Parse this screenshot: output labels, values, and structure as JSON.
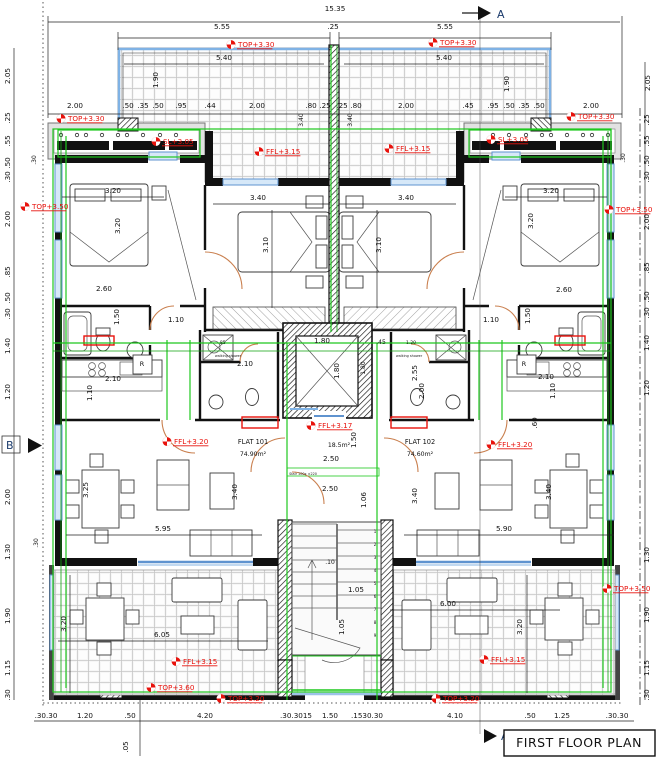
{
  "drawing": {
    "title": "FIRST FLOOR PLAN"
  },
  "section_markers": {
    "top": "A",
    "bottom": "A",
    "left": "B"
  },
  "rooms": {
    "flat1": {
      "name": "FLAT 101",
      "area": "74.90m²"
    },
    "flat2": {
      "name": "FLAT 102",
      "area": "74.60m²"
    },
    "core_area": "18.5m²",
    "stair_note": "Stair 100x ±220",
    "walking_shower": "walking shower",
    "fridge": "R"
  },
  "colors": {
    "annotation_red": "#e8120c",
    "overlay_green": "#1ec81e",
    "window_blue": "#5f93cf",
    "door_orange": "#c97f4e"
  },
  "levels": [
    {
      "t": "TOP+3.30",
      "x": 238,
      "y": 47
    },
    {
      "t": "TOP+3.30",
      "x": 440,
      "y": 45
    },
    {
      "t": "TOP+3.30",
      "x": 68,
      "y": 121
    },
    {
      "t": "TOP+3.30",
      "x": 578,
      "y": 119
    },
    {
      "t": "SL+3.05",
      "x": 163,
      "y": 144
    },
    {
      "t": "SL+3.05",
      "x": 498,
      "y": 142
    },
    {
      "t": "FFL+3.15",
      "x": 266,
      "y": 154
    },
    {
      "t": "FFL+3.15",
      "x": 396,
      "y": 151
    },
    {
      "t": "TOP+3.50",
      "x": 32,
      "y": 209
    },
    {
      "t": "TOP+3.50",
      "x": 616,
      "y": 212
    },
    {
      "t": "FFL+3.17",
      "x": 318,
      "y": 428
    },
    {
      "t": "FFL+3.20",
      "x": 174,
      "y": 444
    },
    {
      "t": "FFL+3.20",
      "x": 498,
      "y": 447
    },
    {
      "t": "FFL+3.15",
      "x": 183,
      "y": 664
    },
    {
      "t": "FFL+3.15",
      "x": 491,
      "y": 662
    },
    {
      "t": "TOP+3.60",
      "x": 158,
      "y": 690
    },
    {
      "t": "TOP+3.20",
      "x": 228,
      "y": 701
    },
    {
      "t": "TOP+3.20",
      "x": 443,
      "y": 701
    },
    {
      "t": "TOP+3.50",
      "x": 614,
      "y": 591
    }
  ],
  "dimensions": [
    {
      "t": "15.35",
      "x": 335,
      "y": 11
    },
    {
      "t": "5.55",
      "x": 222,
      "y": 29
    },
    {
      "t": ".25",
      "x": 333,
      "y": 29
    },
    {
      "t": "5.55",
      "x": 445,
      "y": 29
    },
    {
      "t": "5.40",
      "x": 224,
      "y": 60
    },
    {
      "t": "5.40",
      "x": 444,
      "y": 60
    },
    {
      "t": "1.90",
      "x": 158,
      "y": 80,
      "r": 1
    },
    {
      "t": "1.90",
      "x": 509,
      "y": 84,
      "r": 1
    },
    {
      "t": "2.00",
      "x": 75,
      "y": 108
    },
    {
      "t": ".50",
      "x": 128,
      "y": 108
    },
    {
      "t": ".35",
      "x": 143,
      "y": 108
    },
    {
      "t": ".50",
      "x": 158,
      "y": 108
    },
    {
      "t": ".95",
      "x": 181,
      "y": 108
    },
    {
      "t": ".44",
      "x": 210,
      "y": 108
    },
    {
      "t": "2.00",
      "x": 257,
      "y": 108
    },
    {
      "t": ".80",
      "x": 311,
      "y": 108
    },
    {
      "t": ".25",
      "x": 325,
      "y": 108
    },
    {
      "t": "3.40",
      "x": 303,
      "y": 120,
      "r": 1,
      "s": 6
    },
    {
      "t": "3.40",
      "x": 352,
      "y": 120,
      "r": 1,
      "s": 6
    },
    {
      "t": ".25",
      "x": 342,
      "y": 108
    },
    {
      "t": ".80",
      "x": 356,
      "y": 108
    },
    {
      "t": "2.00",
      "x": 406,
      "y": 108
    },
    {
      "t": ".45",
      "x": 468,
      "y": 108
    },
    {
      "t": ".95",
      "x": 493,
      "y": 108
    },
    {
      "t": ".50",
      "x": 509,
      "y": 108
    },
    {
      "t": ".35",
      "x": 524,
      "y": 108
    },
    {
      "t": ".50",
      "x": 539,
      "y": 108
    },
    {
      "t": "2.00",
      "x": 591,
      "y": 108
    },
    {
      "t": "2.05",
      "x": 650,
      "y": 83,
      "r": 1
    },
    {
      "t": "2.05",
      "x": 10,
      "y": 76,
      "r": 1
    },
    {
      "t": ".25",
      "x": 10,
      "y": 118,
      "r": 1
    },
    {
      "t": ".55",
      "x": 10,
      "y": 141,
      "r": 1
    },
    {
      "t": ".50",
      "x": 10,
      "y": 163,
      "r": 1
    },
    {
      "t": ".30",
      "x": 10,
      "y": 177,
      "r": 1
    },
    {
      "t": "2.00",
      "x": 10,
      "y": 219,
      "r": 1
    },
    {
      "t": ".85",
      "x": 10,
      "y": 272,
      "r": 1
    },
    {
      "t": ".50",
      "x": 10,
      "y": 298,
      "r": 1
    },
    {
      "t": ".30",
      "x": 10,
      "y": 314,
      "r": 1
    },
    {
      "t": "1.40",
      "x": 10,
      "y": 346,
      "r": 1
    },
    {
      "t": "1.20",
      "x": 10,
      "y": 392,
      "r": 1
    },
    {
      "t": "2.00",
      "x": 10,
      "y": 497,
      "r": 1
    },
    {
      "t": "1.30",
      "x": 10,
      "y": 552,
      "r": 1
    },
    {
      "t": "1.90",
      "x": 10,
      "y": 616,
      "r": 1
    },
    {
      "t": "1.15",
      "x": 10,
      "y": 668,
      "r": 1
    },
    {
      "t": ".30",
      "x": 10,
      "y": 695,
      "r": 1
    },
    {
      "t": ".30",
      "x": 36,
      "y": 160,
      "r": 1,
      "s": 6
    },
    {
      "t": ".30",
      "x": 38,
      "y": 543,
      "r": 1,
      "s": 6
    },
    {
      "t": ".30",
      "x": 625,
      "y": 158,
      "r": 1,
      "s": 6
    },
    {
      "t": ".25",
      "x": 649,
      "y": 120,
      "r": 1
    },
    {
      "t": ".55",
      "x": 649,
      "y": 141,
      "r": 1
    },
    {
      "t": ".50",
      "x": 649,
      "y": 161,
      "r": 1
    },
    {
      "t": ".30",
      "x": 649,
      "y": 177,
      "r": 1
    },
    {
      "t": "2.00",
      "x": 649,
      "y": 222,
      "r": 1
    },
    {
      "t": ".85",
      "x": 649,
      "y": 268,
      "r": 1
    },
    {
      "t": ".50",
      "x": 649,
      "y": 297,
      "r": 1
    },
    {
      "t": ".30",
      "x": 649,
      "y": 313,
      "r": 1
    },
    {
      "t": "1.40",
      "x": 649,
      "y": 343,
      "r": 1
    },
    {
      "t": "1.20",
      "x": 649,
      "y": 388,
      "r": 1
    },
    {
      "t": "1.30",
      "x": 649,
      "y": 555,
      "r": 1
    },
    {
      "t": "1.90",
      "x": 649,
      "y": 615,
      "r": 1
    },
    {
      "t": "1.15",
      "x": 649,
      "y": 668,
      "r": 1
    },
    {
      "t": ".30",
      "x": 649,
      "y": 695,
      "r": 1
    },
    {
      "t": ".30.30",
      "x": 46,
      "y": 718
    },
    {
      "t": "1.20",
      "x": 85,
      "y": 718
    },
    {
      "t": ".50",
      "x": 130,
      "y": 718
    },
    {
      "t": "4.20",
      "x": 205,
      "y": 718
    },
    {
      "t": ".30.3015",
      "x": 296,
      "y": 718
    },
    {
      "t": "1.50",
      "x": 330,
      "y": 718
    },
    {
      "t": ".1530.30",
      "x": 367,
      "y": 718
    },
    {
      "t": "4.10",
      "x": 455,
      "y": 718
    },
    {
      "t": ".50",
      "x": 530,
      "y": 718
    },
    {
      "t": "1.25",
      "x": 562,
      "y": 718
    },
    {
      "t": ".30.30",
      "x": 617,
      "y": 718
    },
    {
      "t": ".05",
      "x": 128,
      "y": 747,
      "r": 1
    },
    {
      "t": "3.20",
      "x": 113,
      "y": 193
    },
    {
      "t": "3.20",
      "x": 120,
      "y": 226,
      "r": 1
    },
    {
      "t": "3.40",
      "x": 258,
      "y": 200
    },
    {
      "t": "3.10",
      "x": 268,
      "y": 245,
      "r": 1
    },
    {
      "t": "3.40",
      "x": 406,
      "y": 200
    },
    {
      "t": "3.10",
      "x": 381,
      "y": 245,
      "r": 1
    },
    {
      "t": "3.20",
      "x": 551,
      "y": 193
    },
    {
      "t": "3.20",
      "x": 533,
      "y": 221,
      "r": 1
    },
    {
      "t": "2.60",
      "x": 104,
      "y": 291
    },
    {
      "t": "1.50",
      "x": 119,
      "y": 317,
      "r": 1
    },
    {
      "t": "1.10",
      "x": 176,
      "y": 322
    },
    {
      "t": "2.60",
      "x": 564,
      "y": 292
    },
    {
      "t": "1.50",
      "x": 530,
      "y": 316,
      "r": 1
    },
    {
      "t": "1.10",
      "x": 491,
      "y": 322
    },
    {
      "t": "2.10",
      "x": 245,
      "y": 366
    },
    {
      "t": "2.10",
      "x": 113,
      "y": 381
    },
    {
      "t": "1.10",
      "x": 92,
      "y": 393,
      "r": 1
    },
    {
      "t": "2.55",
      "x": 417,
      "y": 373,
      "r": 1
    },
    {
      "t": "2.00",
      "x": 424,
      "y": 391,
      "r": 1
    },
    {
      "t": "2.10",
      "x": 546,
      "y": 379
    },
    {
      "t": "1.10",
      "x": 555,
      "y": 391,
      "r": 1
    },
    {
      "t": ".60",
      "x": 537,
      "y": 423,
      "r": 1
    },
    {
      "t": "1.80",
      "x": 322,
      "y": 343
    },
    {
      "t": "1.80",
      "x": 339,
      "y": 371,
      "r": 1
    },
    {
      "t": ".45",
      "x": 381,
      "y": 344,
      "s": 6
    },
    {
      "t": "1.80",
      "x": 365,
      "y": 368,
      "r": 1,
      "s": 6
    },
    {
      "t": "1.50",
      "x": 356,
      "y": 440,
      "r": 1
    },
    {
      "t": "2.50",
      "x": 331,
      "y": 461
    },
    {
      "t": "2.50",
      "x": 330,
      "y": 491
    },
    {
      "t": "1.06",
      "x": 366,
      "y": 500,
      "r": 1
    },
    {
      "t": ".10",
      "x": 330,
      "y": 564,
      "s": 6
    },
    {
      "t": "1.05",
      "x": 356,
      "y": 592
    },
    {
      "t": "1.05",
      "x": 344,
      "y": 627,
      "r": 1
    },
    {
      "t": "3.25",
      "x": 88,
      "y": 490,
      "r": 1
    },
    {
      "t": "3.40",
      "x": 237,
      "y": 492,
      "r": 1
    },
    {
      "t": "5.95",
      "x": 163,
      "y": 531
    },
    {
      "t": "3.40",
      "x": 417,
      "y": 496,
      "r": 1
    },
    {
      "t": "3.40",
      "x": 551,
      "y": 492,
      "r": 1
    },
    {
      "t": "5.90",
      "x": 504,
      "y": 531
    },
    {
      "t": "3.20",
      "x": 66,
      "y": 624,
      "r": 1
    },
    {
      "t": "6.05",
      "x": 162,
      "y": 637
    },
    {
      "t": "6.00",
      "x": 448,
      "y": 606
    },
    {
      "t": "3.20",
      "x": 522,
      "y": 627,
      "r": 1
    },
    {
      "t": ".85",
      "x": 222,
      "y": 344,
      "s": 4.5
    },
    {
      "t": "1.20",
      "x": 411,
      "y": 344,
      "s": 4.5
    }
  ],
  "stair_numbers": [
    "1",
    "2",
    "3",
    "4",
    "5",
    "6",
    "7",
    "8",
    "9"
  ]
}
